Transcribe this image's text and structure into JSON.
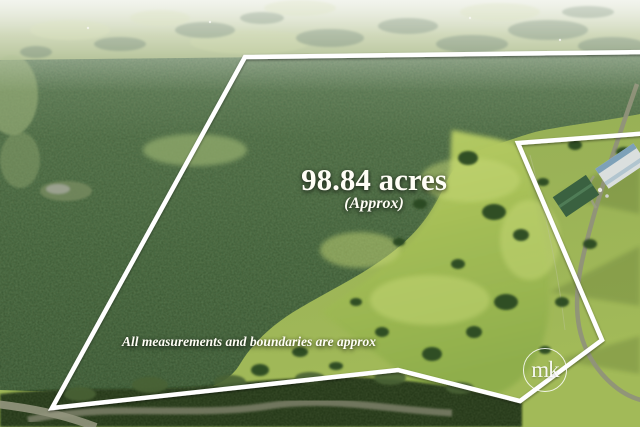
{
  "scene": {
    "description": "Aerial photograph of rural bushland acreage with white property boundary outline"
  },
  "overlay": {
    "area": "98.84 acres",
    "approx": "(Approx)",
    "disclaimer": "All measurements and boundaries are approx",
    "text_color": "#fffef6"
  },
  "watermark": {
    "monogram": "mk",
    "shape": "circle-outline",
    "color": "#ffffff"
  },
  "boundary": {
    "points": "650,52 245,57 52,408 398,370 520,401 602,340 518,143 650,133",
    "color": "#ffffff",
    "stroke_width": "4.5"
  },
  "palette": {
    "forest_dark": "#314a28",
    "forest_mid": "#3a5530",
    "pasture_bright": "#a3bd55",
    "hills_haze": "#dee3d2",
    "road_gravel": "#90927a"
  }
}
